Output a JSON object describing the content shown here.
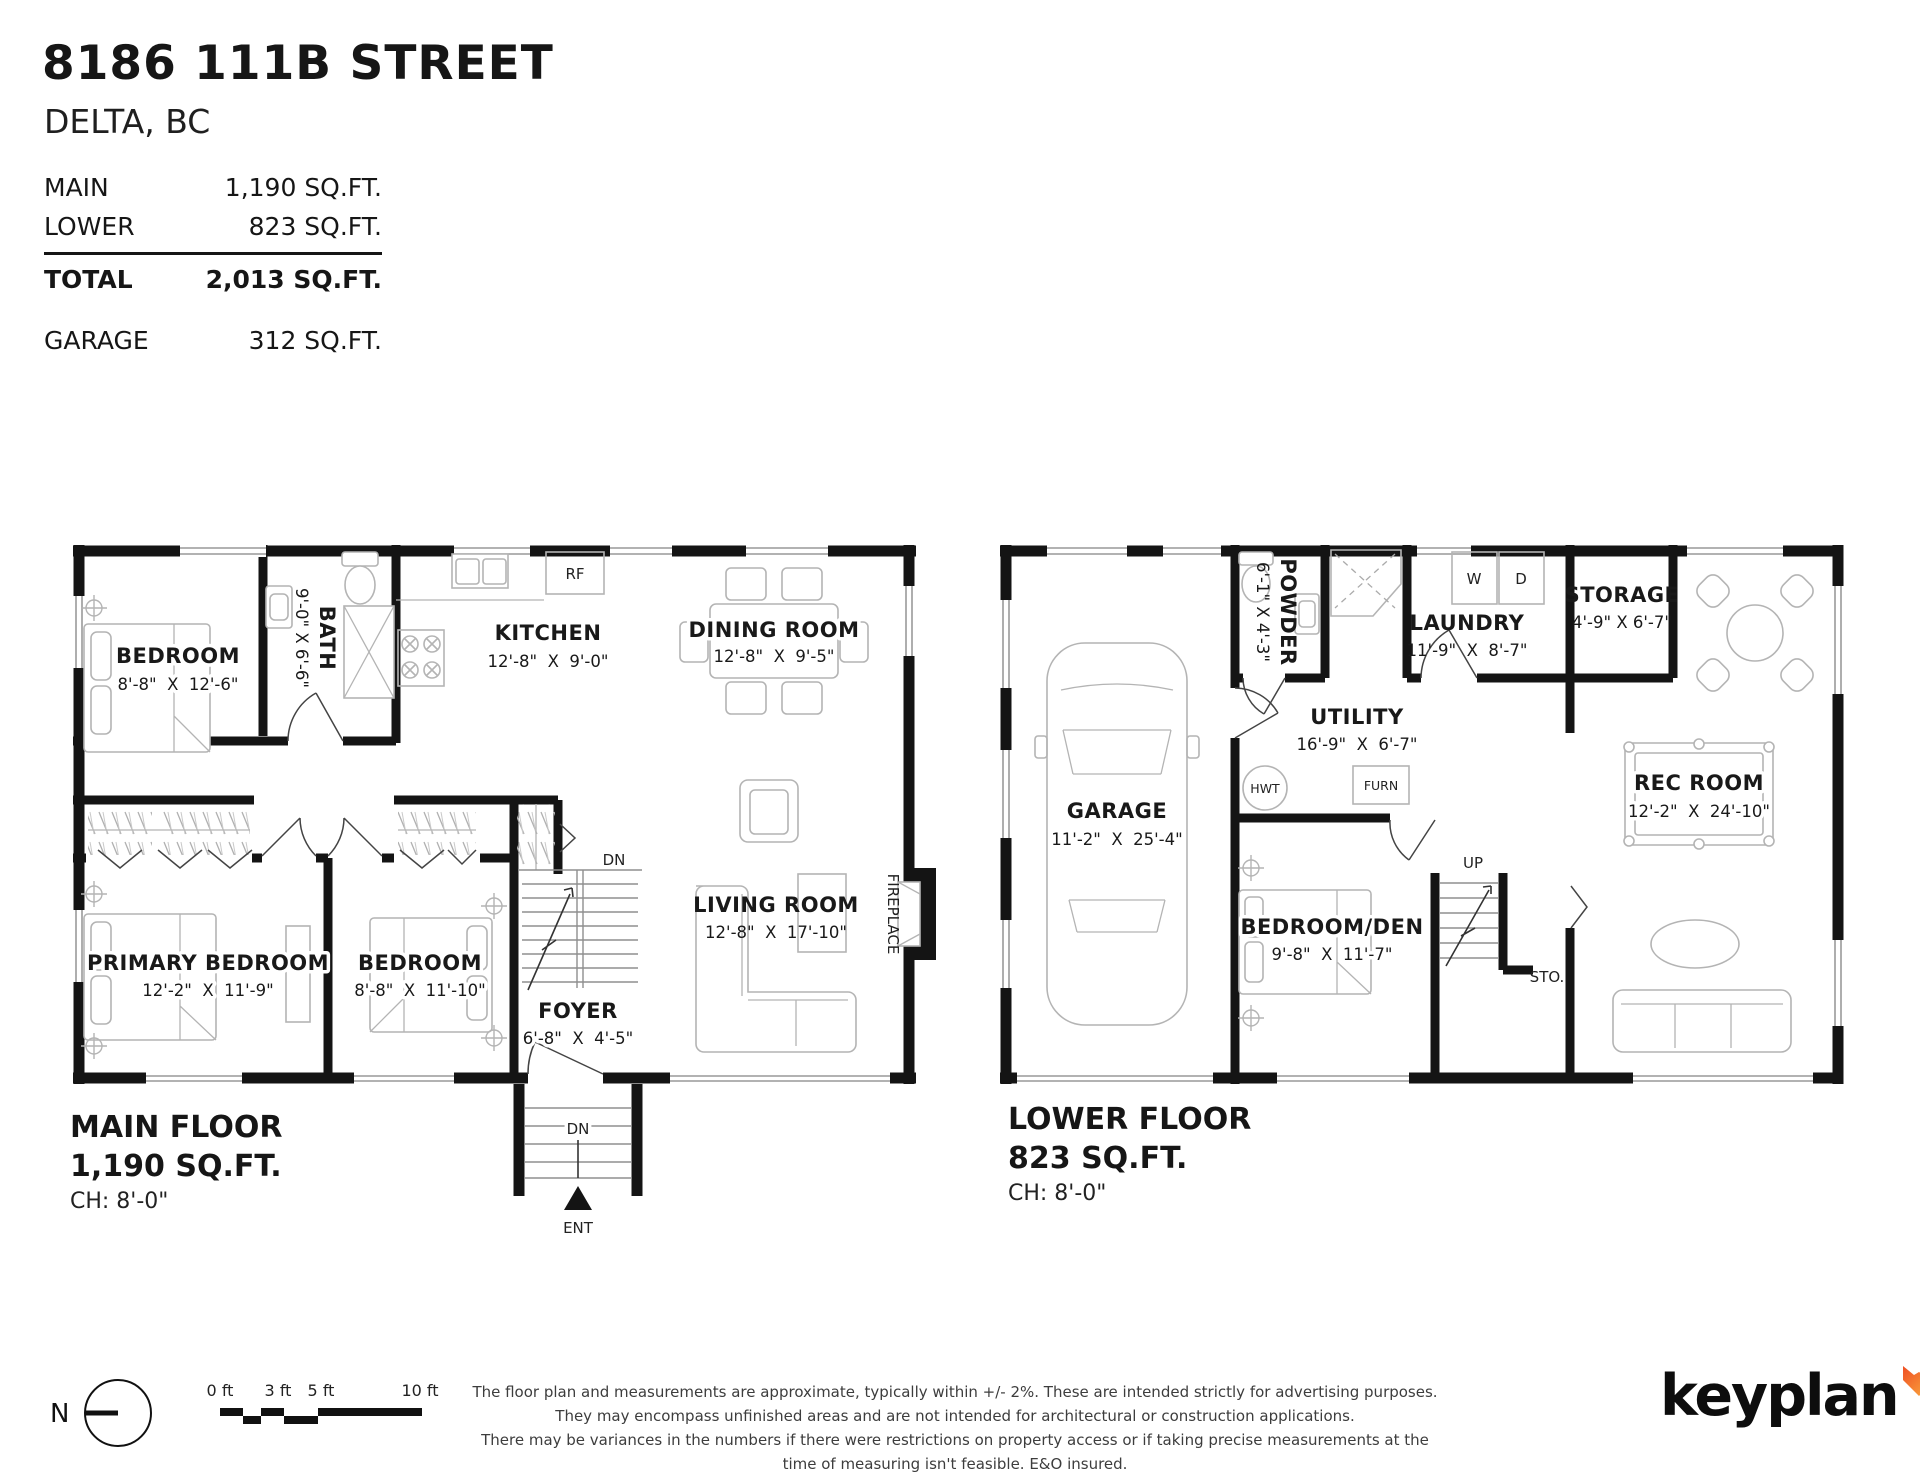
{
  "header": {
    "address": "8186 111B STREET",
    "city": "DELTA, BC",
    "rows": [
      {
        "label": "MAIN",
        "value": "1,190 SQ.FT."
      },
      {
        "label": "LOWER",
        "value": "823 SQ.FT."
      }
    ],
    "total_row": {
      "label": "TOTAL",
      "value": "2,013 SQ.FT."
    },
    "garage_row": {
      "label": "GARAGE",
      "value": "312 SQ.FT."
    }
  },
  "main_floor": {
    "title": "MAIN FLOOR",
    "area": "1,190 SQ.FT.",
    "ceiling_height": "CH: 8'-0\"",
    "rooms": {
      "bedroom1": {
        "name": "BEDROOM",
        "dims": "8'-8\"  X  12'-6\""
      },
      "bath": {
        "name": "BATH",
        "dims": "9'-0\" X 6'-6\""
      },
      "kitchen": {
        "name": "KITCHEN",
        "dims": "12'-8\"  X  9'-0\""
      },
      "dining": {
        "name": "DINING ROOM",
        "dims": "12'-8\"  X  9'-5\""
      },
      "primary": {
        "name": "PRIMARY BEDROOM",
        "dims": "12'-2\"  X  11'-9\""
      },
      "bedroom2": {
        "name": "BEDROOM",
        "dims": "8'-8\"  X  11'-10\""
      },
      "foyer": {
        "name": "FOYER",
        "dims": "6'-8\"  X  4'-5\""
      },
      "living": {
        "name": "LIVING ROOM",
        "dims": "12'-8\"  X  17'-10\""
      }
    },
    "markers": {
      "rf": "RF",
      "dn": "DN",
      "ent": "ENT",
      "fireplace": "FIREPLACE"
    }
  },
  "lower_floor": {
    "title": "LOWER FLOOR",
    "area": "823 SQ.FT.",
    "ceiling_height": "CH: 8'-0\"",
    "rooms": {
      "garage": {
        "name": "GARAGE",
        "dims": "11'-2\"  X  25'-4\""
      },
      "powder": {
        "name": "POWDER",
        "dims": "6'-1\" X 4'-3\""
      },
      "laundry": {
        "name": "LAUNDRY",
        "dims": "11'-9\"  X  8'-7\""
      },
      "storage": {
        "name": "STORAGE",
        "dims": "4'-9\" X 6'-7\""
      },
      "utility": {
        "name": "UTILITY",
        "dims": "16'-9\"  X  6'-7\""
      },
      "bedroom_den": {
        "name": "BEDROOM/DEN",
        "dims": "9'-8\"  X  11'-7\""
      },
      "rec": {
        "name": "REC ROOM",
        "dims": "12'-2\"  X  24'-10\""
      }
    },
    "markers": {
      "hwt": "HWT",
      "furn": "FURN",
      "up": "UP",
      "sto": "STO.",
      "w": "W",
      "d": "D"
    }
  },
  "footer": {
    "north_label": "N",
    "scale_ticks": [
      "0 ft",
      "3 ft",
      "5 ft",
      "10 ft"
    ],
    "disclaimer": [
      "The floor plan and measurements are approximate, typically within +/- 2%. These are intended strictly for advertising purposes.",
      "They may encompass unfinished areas and are not intended for architectural or construction applications.",
      "There may be variances in the numbers if there were restrictions on property access or if taking precise measurements at the time of measuring isn't feasible. E&O insured."
    ],
    "brand": "keyplan"
  }
}
